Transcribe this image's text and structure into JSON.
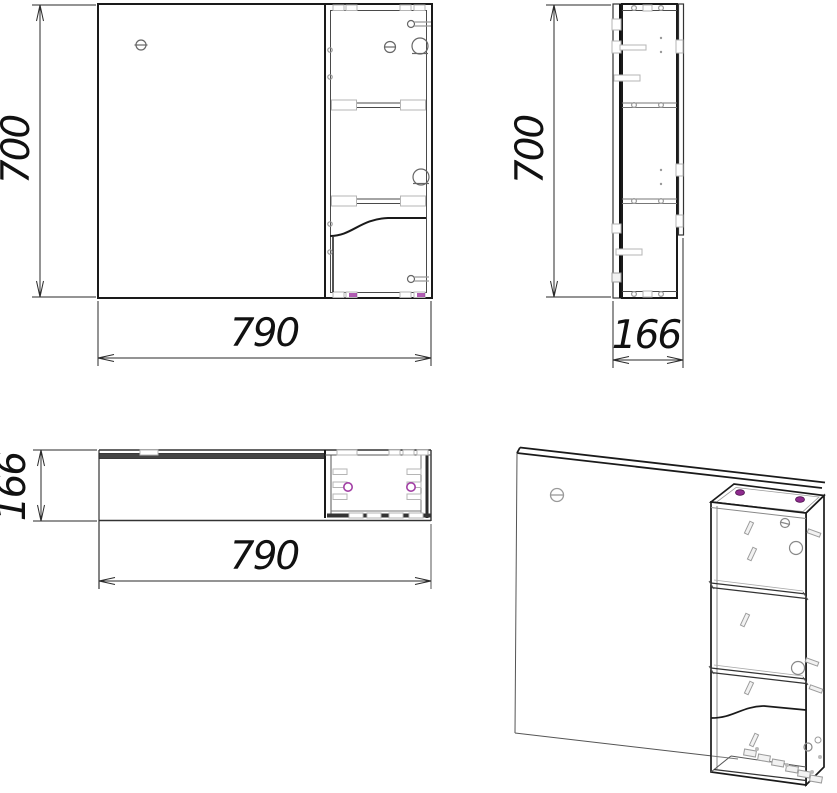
{
  "drawing": {
    "labels": {
      "front_height": "700",
      "front_width": "790",
      "side_height": "700",
      "side_depth": "166",
      "plan_depth": "166",
      "plan_width": "790"
    },
    "colors": {
      "outline": "#1a1a1a",
      "medium_line": "#555555",
      "detail_gray": "#b5b5b5",
      "accent_magenta": "#a23fa5",
      "background": "#ffffff"
    }
  }
}
